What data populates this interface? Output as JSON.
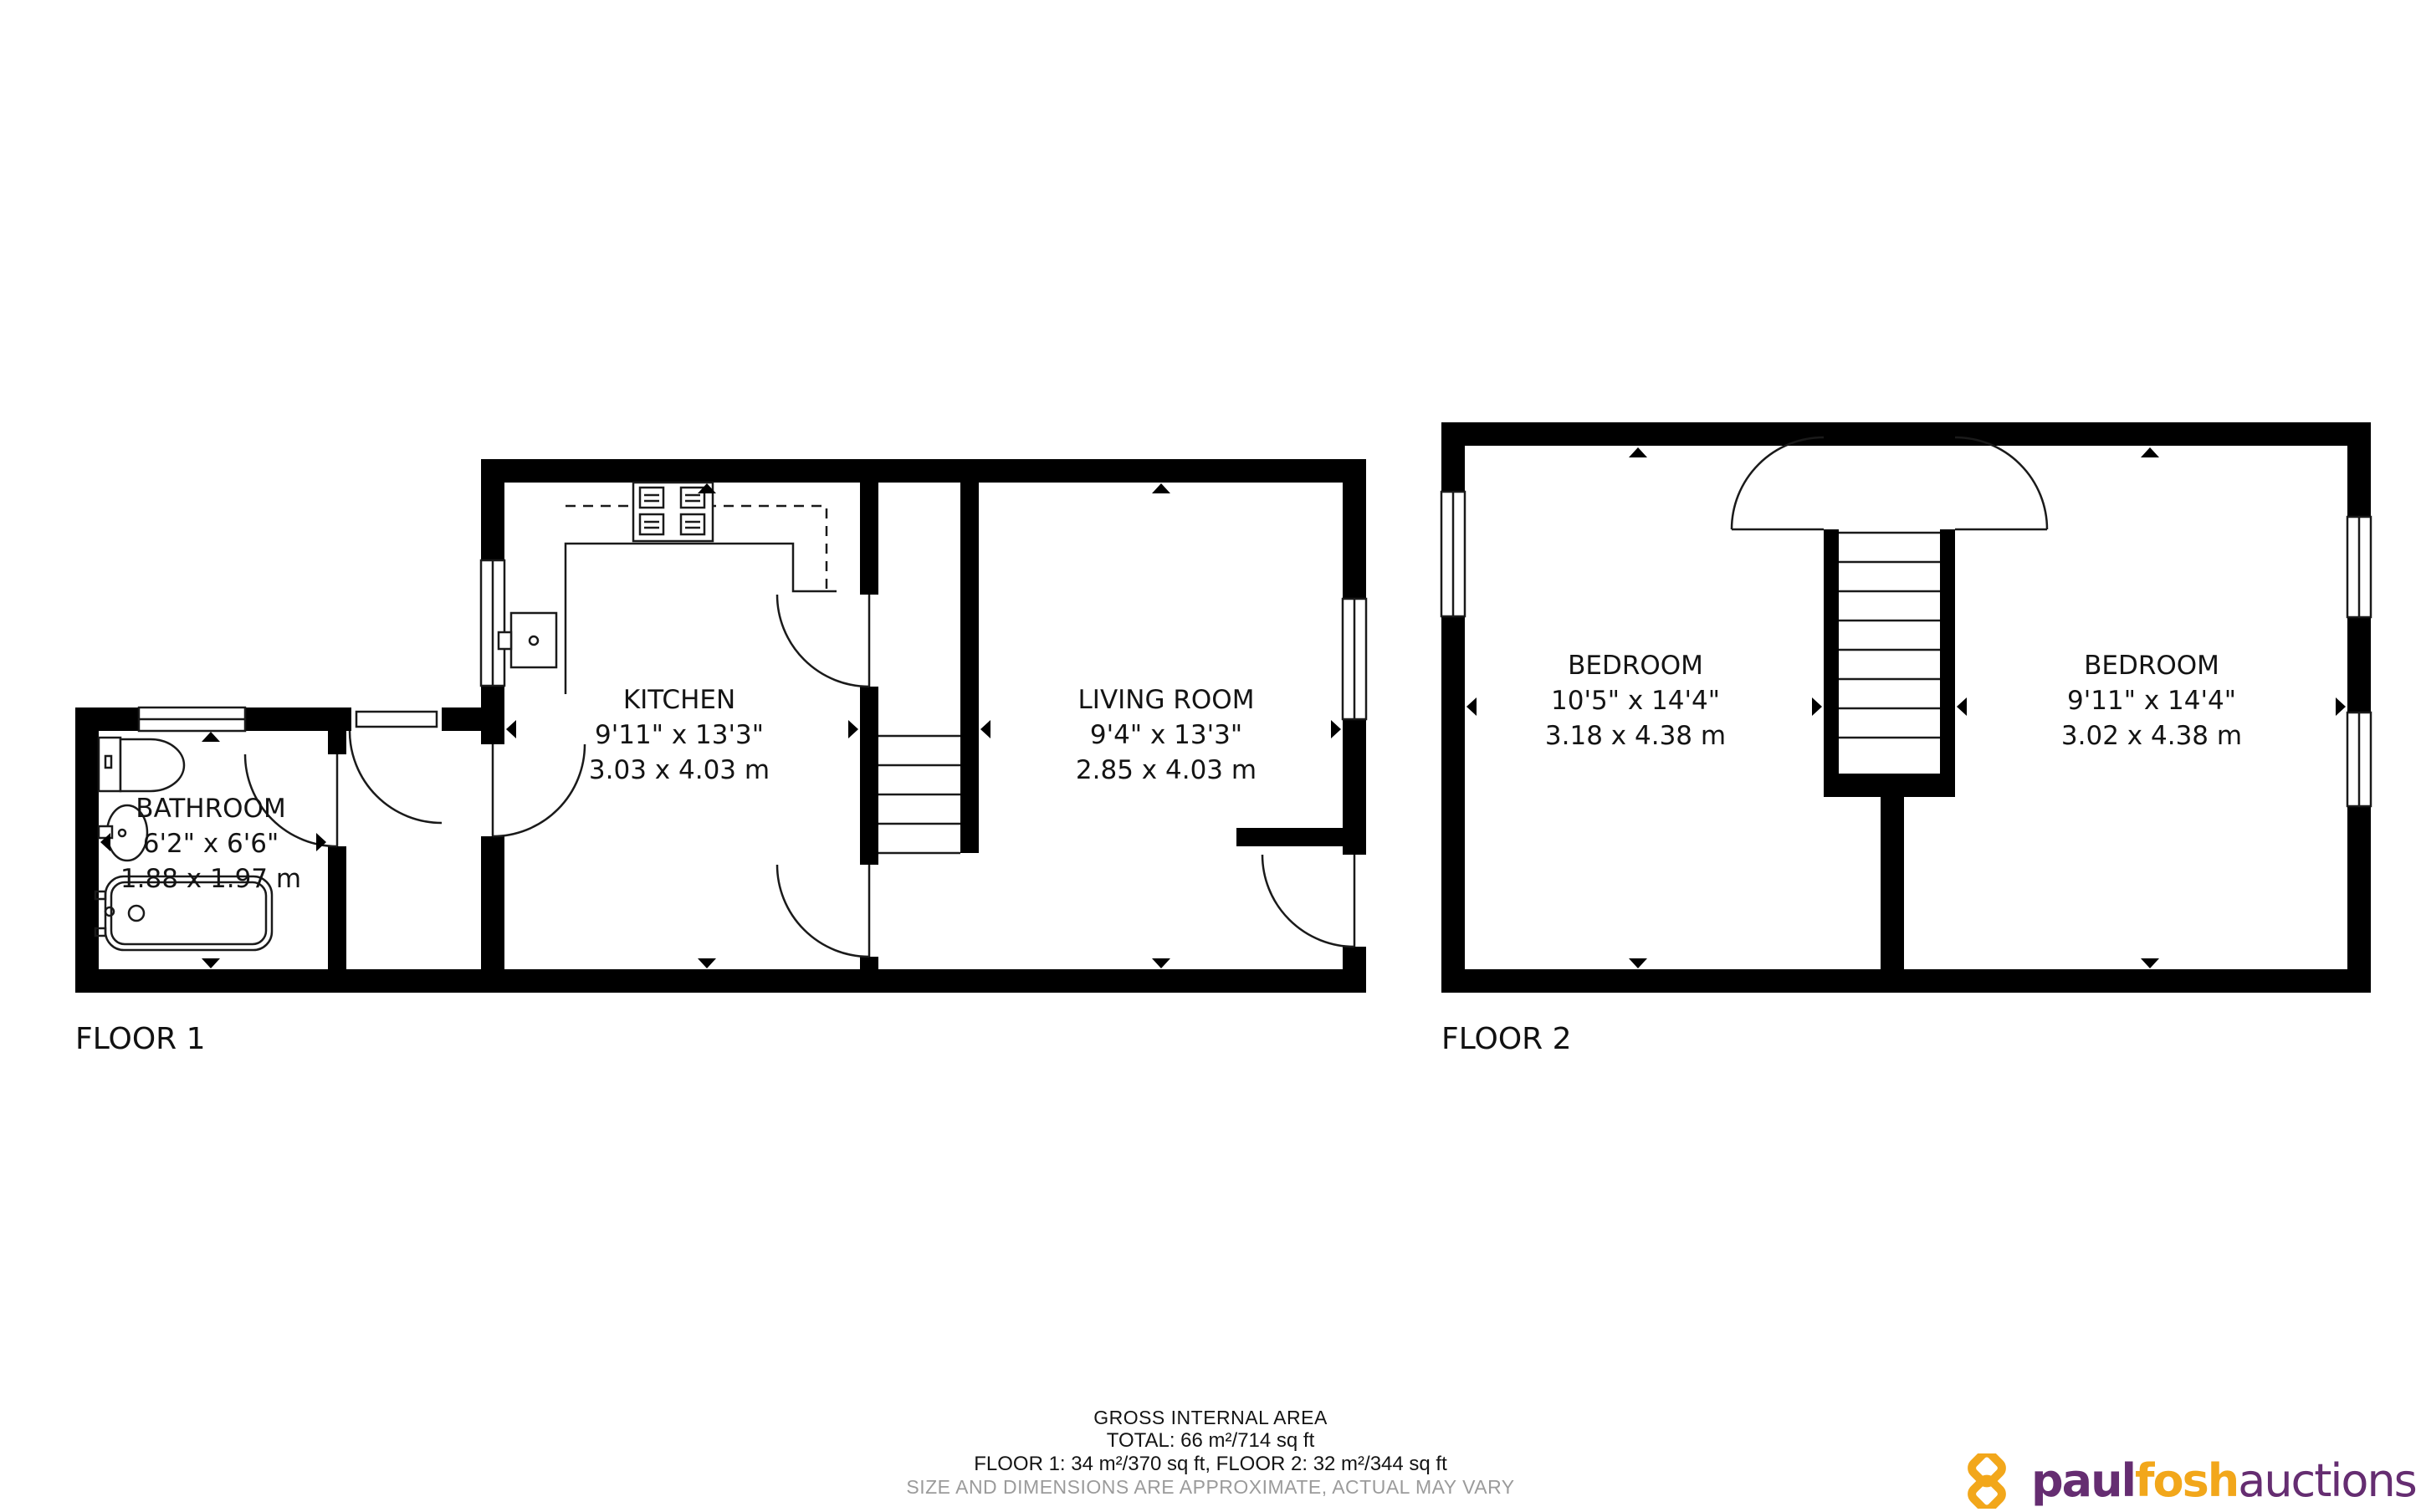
{
  "floor1": {
    "label": "FLOOR 1",
    "rooms": {
      "bathroom": {
        "name": "BATHROOM",
        "imperial": "6'2\" x 6'6\"",
        "metric": "1.88 x 1.97 m"
      },
      "kitchen": {
        "name": "KITCHEN",
        "imperial": "9'11\" x 13'3\"",
        "metric": "3.03 x 4.03 m"
      },
      "living_room": {
        "name": "LIVING ROOM",
        "imperial": "9'4\" x 13'3\"",
        "metric": "2.85 x 4.03 m"
      }
    }
  },
  "floor2": {
    "label": "FLOOR 2",
    "rooms": {
      "bedroom_left": {
        "name": "BEDROOM",
        "imperial": "10'5\" x 14'4\"",
        "metric": "3.18 x 4.38 m"
      },
      "bedroom_right": {
        "name": "BEDROOM",
        "imperial": "9'11\" x 14'4\"",
        "metric": "3.02 x 4.38 m"
      }
    }
  },
  "footer": {
    "line1": "GROSS INTERNAL AREA",
    "line2": "TOTAL: 66 m²/714 sq ft",
    "line3": "FLOOR 1: 34 m²/370 sq ft, FLOOR 2: 32 m²/344 sq ft",
    "line4": "SIZE AND DIMENSIONS ARE APPROXIMATE, ACTUAL MAY VARY"
  },
  "logo": {
    "part1": "paul",
    "part2": "fosh",
    "part3": "auctions",
    "gold": "#F2A71B",
    "purple": "#652D71"
  },
  "colors": {
    "wall": "#000000",
    "line": "#1a1a1a",
    "muted_text": "#9b9b9b"
  }
}
